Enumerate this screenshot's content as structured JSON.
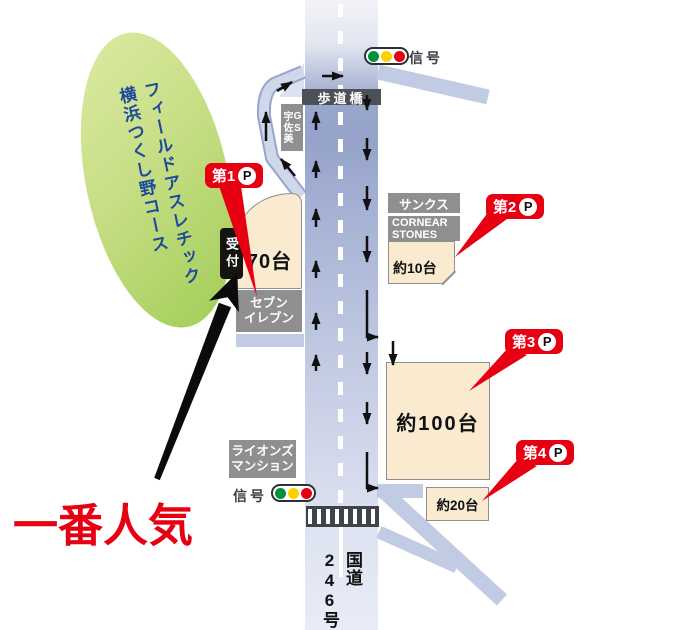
{
  "map": {
    "venue": {
      "line1": "フィールドアスレチック",
      "line2": "横浜つくし野コース"
    },
    "route_sign": {
      "line1": "国道",
      "line2": "246号"
    },
    "signal_label": "信号",
    "bridge_label": "歩道橋",
    "reception_label": "受付",
    "most_popular": "一番人気",
    "p_letter": "P",
    "parking": [
      {
        "badge": "第1",
        "capacity": "70台"
      },
      {
        "badge": "第2",
        "capacity": "約10台"
      },
      {
        "badge": "第3",
        "capacity": "約100台"
      },
      {
        "badge": "第4",
        "capacity": "約20台"
      }
    ],
    "buildings": {
      "gas_station": {
        "line1": "GS",
        "line2": "宇佐美"
      },
      "sunkus": "サンクス",
      "cornear": {
        "line1": "CORNEAR",
        "line2": "STONES"
      },
      "seven_eleven": {
        "line1": "セブン",
        "line2": "イレブン"
      },
      "lions_mansion": {
        "line1": "ライオンズ",
        "line2": "マンション"
      }
    },
    "colors": {
      "accent_red": "#e60012",
      "road_blue": "#a9b5d6",
      "building_gray": "#8f8f8f",
      "lot_beige": "#f9ead0",
      "ellipse_green": "#a5cf5c",
      "venue_text_blue": "#1d4a9d",
      "signal_green": "#00913a",
      "signal_yellow": "#fdd000"
    }
  }
}
